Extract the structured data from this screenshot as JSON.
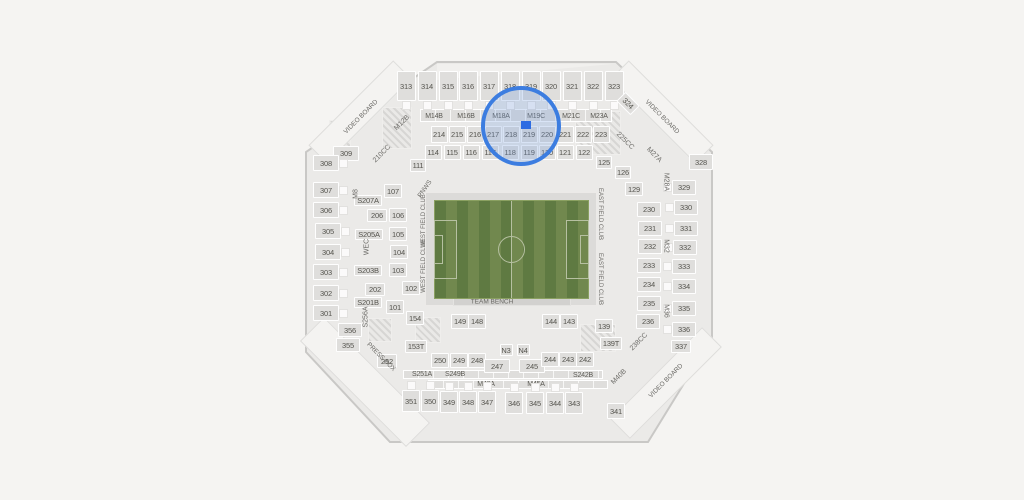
{
  "app": {
    "description": "Stadium seating map with zoom highlight on section 219"
  },
  "colors": {
    "background": "#f5f4f2",
    "bowl_fill": "#ebeae8",
    "bowl_stroke": "#c9c8c6",
    "section_fill": "#dfdedc",
    "section_border": "#ffffff",
    "label": "#55544e",
    "field_dark": "#5f7a42",
    "field_light": "#71884e",
    "field_lines": "#b6c0a1",
    "highlight_stroke": "#3c7de0",
    "highlight_fill": "rgba(120,158,223,0.28)",
    "marker_blue": "#2e6ce2"
  },
  "highlight": {
    "cx": 521,
    "cy": 126,
    "d": 80,
    "marker": {
      "x": 521,
      "y": 121,
      "w": 10,
      "h": 8
    }
  },
  "strips": [
    {
      "x": 516,
      "y": 115,
      "w": 192,
      "h": 13
    },
    {
      "x": 503,
      "y": 374,
      "w": 200,
      "h": 9
    },
    {
      "x": 518,
      "y": 384,
      "w": 180,
      "h": 9
    },
    {
      "x": 511,
      "y": 249,
      "w": 172,
      "h": 114,
      "c": "frame"
    },
    {
      "x": 512,
      "y": 301,
      "w": 118,
      "h": 9,
      "c": "bench"
    }
  ],
  "videoboards": [
    {
      "x": 360,
      "y": 112,
      "w": 120,
      "h": 26,
      "r": -45
    },
    {
      "x": 662,
      "y": 112,
      "w": 120,
      "h": 26,
      "r": 45
    },
    {
      "x": 666,
      "y": 383,
      "w": 130,
      "h": 28,
      "r": -45
    },
    {
      "x": 365,
      "y": 382,
      "w": 150,
      "h": 34,
      "r": 45
    }
  ],
  "hatches": [
    {
      "x": 397,
      "y": 128,
      "w": 30,
      "h": 42
    },
    {
      "x": 340,
      "y": 135,
      "w": 22,
      "h": 30
    },
    {
      "x": 598,
      "y": 133,
      "w": 46,
      "h": 44
    },
    {
      "x": 428,
      "y": 330,
      "w": 26,
      "h": 26
    },
    {
      "x": 598,
      "y": 338,
      "w": 36,
      "h": 28
    },
    {
      "x": 380,
      "y": 330,
      "w": 24,
      "h": 24
    }
  ],
  "sections": [
    {
      "t": "313",
      "x": 406,
      "y": 86,
      "w": 19,
      "h": 30,
      "c": "amb"
    },
    {
      "t": "314",
      "x": 427,
      "y": 86,
      "w": 19,
      "h": 30,
      "c": "amb"
    },
    {
      "t": "315",
      "x": 448,
      "y": 86,
      "w": 19,
      "h": 30,
      "c": "amb"
    },
    {
      "t": "316",
      "x": 468,
      "y": 86,
      "w": 19,
      "h": 30,
      "c": "amb"
    },
    {
      "t": "317",
      "x": 489,
      "y": 86,
      "w": 19,
      "h": 30,
      "c": "amb"
    },
    {
      "t": "318",
      "x": 510,
      "y": 86,
      "w": 19,
      "h": 30,
      "c": "amb"
    },
    {
      "t": "319",
      "x": 531,
      "y": 86,
      "w": 19,
      "h": 30,
      "c": "amb"
    },
    {
      "t": "320",
      "x": 551,
      "y": 86,
      "w": 19,
      "h": 30,
      "c": "amb"
    },
    {
      "t": "321",
      "x": 572,
      "y": 86,
      "w": 19,
      "h": 30,
      "c": "amb"
    },
    {
      "t": "322",
      "x": 593,
      "y": 86,
      "w": 19,
      "h": 30,
      "c": "amb"
    },
    {
      "t": "323",
      "x": 614,
      "y": 86,
      "w": 19,
      "h": 30,
      "c": "amb"
    },
    {
      "t": "324",
      "x": 628,
      "y": 103,
      "w": 20,
      "h": 13,
      "r": 45
    },
    {
      "t": "M14B",
      "x": 434,
      "y": 116,
      "w": 28,
      "h": 11,
      "c": "mbox"
    },
    {
      "t": "M16B",
      "x": 466,
      "y": 116,
      "w": 28,
      "h": 11,
      "c": "mbox"
    },
    {
      "t": "M18A",
      "x": 501,
      "y": 116,
      "w": 28,
      "h": 11,
      "c": "mbox"
    },
    {
      "t": "M19C",
      "x": 536,
      "y": 116,
      "w": 28,
      "h": 11,
      "c": "mbox"
    },
    {
      "t": "M21C",
      "x": 571,
      "y": 116,
      "w": 28,
      "h": 11,
      "c": "mbox"
    },
    {
      "t": "M23A",
      "x": 599,
      "y": 116,
      "w": 28,
      "h": 11,
      "c": "mbox"
    },
    {
      "t": "214",
      "x": 439,
      "y": 134,
      "w": 17,
      "h": 17
    },
    {
      "t": "215",
      "x": 457,
      "y": 134,
      "w": 17,
      "h": 17
    },
    {
      "t": "216",
      "x": 475,
      "y": 134,
      "w": 17,
      "h": 17
    },
    {
      "t": "217",
      "x": 493,
      "y": 134,
      "w": 17,
      "h": 17
    },
    {
      "t": "218",
      "x": 511,
      "y": 134,
      "w": 17,
      "h": 17
    },
    {
      "t": "219",
      "x": 529,
      "y": 134,
      "w": 17,
      "h": 17
    },
    {
      "t": "220",
      "x": 547,
      "y": 134,
      "w": 17,
      "h": 17
    },
    {
      "t": "221",
      "x": 565,
      "y": 134,
      "w": 17,
      "h": 17
    },
    {
      "t": "222",
      "x": 583,
      "y": 134,
      "w": 17,
      "h": 17
    },
    {
      "t": "223",
      "x": 601,
      "y": 134,
      "w": 17,
      "h": 17
    },
    {
      "t": "114",
      "x": 433,
      "y": 152,
      "w": 17,
      "h": 15
    },
    {
      "t": "115",
      "x": 452,
      "y": 152,
      "w": 17,
      "h": 15
    },
    {
      "t": "116",
      "x": 471,
      "y": 152,
      "w": 17,
      "h": 15
    },
    {
      "t": "117",
      "x": 490,
      "y": 152,
      "w": 17,
      "h": 15
    },
    {
      "t": "118",
      "x": 510,
      "y": 152,
      "w": 17,
      "h": 15
    },
    {
      "t": "119",
      "x": 529,
      "y": 152,
      "w": 17,
      "h": 15
    },
    {
      "t": "120",
      "x": 547,
      "y": 152,
      "w": 17,
      "h": 15
    },
    {
      "t": "121",
      "x": 565,
      "y": 152,
      "w": 17,
      "h": 15
    },
    {
      "t": "122",
      "x": 584,
      "y": 152,
      "w": 17,
      "h": 15
    },
    {
      "t": "111",
      "x": 418,
      "y": 165,
      "w": 16,
      "h": 13
    },
    {
      "t": "125",
      "x": 604,
      "y": 162,
      "w": 16,
      "h": 13
    },
    {
      "t": "126",
      "x": 623,
      "y": 172,
      "w": 16,
      "h": 13
    },
    {
      "t": "129",
      "x": 634,
      "y": 189,
      "w": 18,
      "h": 14
    },
    {
      "t": "309",
      "x": 346,
      "y": 153,
      "w": 26,
      "h": 15
    },
    {
      "t": "308",
      "x": 326,
      "y": 163,
      "w": 26,
      "h": 16,
      "c": "amr"
    },
    {
      "t": "307",
      "x": 326,
      "y": 190,
      "w": 26,
      "h": 16,
      "c": "amr"
    },
    {
      "t": "306",
      "x": 326,
      "y": 210,
      "w": 26,
      "h": 16,
      "c": "amr"
    },
    {
      "t": "305",
      "x": 328,
      "y": 231,
      "w": 26,
      "h": 16,
      "c": "amr"
    },
    {
      "t": "304",
      "x": 328,
      "y": 252,
      "w": 26,
      "h": 16,
      "c": "amr"
    },
    {
      "t": "303",
      "x": 326,
      "y": 272,
      "w": 26,
      "h": 16,
      "c": "amr"
    },
    {
      "t": "302",
      "x": 326,
      "y": 293,
      "w": 26,
      "h": 16,
      "c": "amr"
    },
    {
      "t": "301",
      "x": 326,
      "y": 313,
      "w": 26,
      "h": 16,
      "c": "amr"
    },
    {
      "t": "356",
      "x": 350,
      "y": 330,
      "w": 24,
      "h": 14
    },
    {
      "t": "355",
      "x": 348,
      "y": 345,
      "w": 24,
      "h": 14
    },
    {
      "t": "S207A",
      "x": 368,
      "y": 200,
      "w": 28,
      "h": 11
    },
    {
      "t": "206",
      "x": 377,
      "y": 215,
      "w": 20,
      "h": 13
    },
    {
      "t": "S205A",
      "x": 369,
      "y": 234,
      "w": 28,
      "h": 11
    },
    {
      "t": "S203B",
      "x": 368,
      "y": 270,
      "w": 28,
      "h": 11
    },
    {
      "t": "202",
      "x": 375,
      "y": 289,
      "w": 20,
      "h": 13
    },
    {
      "t": "S201B",
      "x": 368,
      "y": 302,
      "w": 28,
      "h": 11
    },
    {
      "t": "107",
      "x": 393,
      "y": 191,
      "w": 18,
      "h": 14
    },
    {
      "t": "106",
      "x": 398,
      "y": 215,
      "w": 18,
      "h": 14
    },
    {
      "t": "105",
      "x": 398,
      "y": 234,
      "w": 18,
      "h": 14
    },
    {
      "t": "104",
      "x": 399,
      "y": 252,
      "w": 18,
      "h": 14
    },
    {
      "t": "103",
      "x": 398,
      "y": 270,
      "w": 18,
      "h": 14
    },
    {
      "t": "102",
      "x": 411,
      "y": 288,
      "w": 18,
      "h": 14
    },
    {
      "t": "101",
      "x": 395,
      "y": 307,
      "w": 18,
      "h": 14
    },
    {
      "t": "154",
      "x": 415,
      "y": 318,
      "w": 18,
      "h": 14
    },
    {
      "t": "230",
      "x": 649,
      "y": 209,
      "w": 24,
      "h": 15
    },
    {
      "t": "231",
      "x": 650,
      "y": 228,
      "w": 24,
      "h": 15
    },
    {
      "t": "232",
      "x": 650,
      "y": 246,
      "w": 24,
      "h": 15
    },
    {
      "t": "233",
      "x": 649,
      "y": 265,
      "w": 24,
      "h": 15
    },
    {
      "t": "234",
      "x": 649,
      "y": 284,
      "w": 24,
      "h": 15
    },
    {
      "t": "235",
      "x": 649,
      "y": 303,
      "w": 24,
      "h": 15
    },
    {
      "t": "236",
      "x": 648,
      "y": 321,
      "w": 24,
      "h": 15
    },
    {
      "t": "328",
      "x": 701,
      "y": 162,
      "w": 24,
      "h": 16
    },
    {
      "t": "329",
      "x": 684,
      "y": 187,
      "w": 24,
      "h": 15,
      "c": "aml"
    },
    {
      "t": "330",
      "x": 686,
      "y": 207,
      "w": 24,
      "h": 15,
      "c": "aml"
    },
    {
      "t": "331",
      "x": 686,
      "y": 228,
      "w": 24,
      "h": 15,
      "c": "aml"
    },
    {
      "t": "332",
      "x": 685,
      "y": 247,
      "w": 24,
      "h": 15,
      "c": "aml"
    },
    {
      "t": "333",
      "x": 684,
      "y": 266,
      "w": 24,
      "h": 15,
      "c": "aml"
    },
    {
      "t": "334",
      "x": 684,
      "y": 286,
      "w": 24,
      "h": 15,
      "c": "aml"
    },
    {
      "t": "335",
      "x": 684,
      "y": 308,
      "w": 24,
      "h": 15,
      "c": "aml"
    },
    {
      "t": "336",
      "x": 684,
      "y": 329,
      "w": 24,
      "h": 15,
      "c": "aml"
    },
    {
      "t": "337",
      "x": 681,
      "y": 346,
      "w": 20,
      "h": 13
    },
    {
      "t": "149",
      "x": 460,
      "y": 321,
      "w": 18,
      "h": 15
    },
    {
      "t": "148",
      "x": 477,
      "y": 321,
      "w": 18,
      "h": 15
    },
    {
      "t": "144",
      "x": 551,
      "y": 321,
      "w": 18,
      "h": 15
    },
    {
      "t": "143",
      "x": 569,
      "y": 321,
      "w": 18,
      "h": 15
    },
    {
      "t": "139",
      "x": 604,
      "y": 326,
      "w": 18,
      "h": 14
    },
    {
      "t": "153T",
      "x": 416,
      "y": 346,
      "w": 22,
      "h": 13
    },
    {
      "t": "139T",
      "x": 611,
      "y": 343,
      "w": 22,
      "h": 13
    },
    {
      "t": "N3",
      "x": 506,
      "y": 350,
      "w": 13,
      "h": 12
    },
    {
      "t": "N4",
      "x": 523,
      "y": 350,
      "w": 13,
      "h": 12
    },
    {
      "t": "252",
      "x": 387,
      "y": 361,
      "w": 20,
      "h": 14
    },
    {
      "t": "250",
      "x": 440,
      "y": 360,
      "w": 18,
      "h": 15
    },
    {
      "t": "249",
      "x": 459,
      "y": 360,
      "w": 18,
      "h": 15
    },
    {
      "t": "248",
      "x": 477,
      "y": 360,
      "w": 18,
      "h": 15
    },
    {
      "t": "247",
      "x": 497,
      "y": 366,
      "w": 26,
      "h": 14
    },
    {
      "t": "245",
      "x": 532,
      "y": 366,
      "w": 26,
      "h": 14
    },
    {
      "t": "244",
      "x": 550,
      "y": 359,
      "w": 18,
      "h": 15
    },
    {
      "t": "243",
      "x": 568,
      "y": 359,
      "w": 18,
      "h": 15
    },
    {
      "t": "242",
      "x": 585,
      "y": 359,
      "w": 18,
      "h": 15
    },
    {
      "t": "S251A",
      "x": 422,
      "y": 374,
      "w": 30,
      "h": 9,
      "c": "mbox"
    },
    {
      "t": "S249B",
      "x": 455,
      "y": 374,
      "w": 30,
      "h": 9,
      "c": "mbox"
    },
    {
      "t": "S242B",
      "x": 583,
      "y": 375,
      "w": 30,
      "h": 9,
      "c": "mbox"
    },
    {
      "t": "M48A",
      "x": 486,
      "y": 384,
      "w": 28,
      "h": 9,
      "c": "mbox"
    },
    {
      "t": "M45A",
      "x": 536,
      "y": 384,
      "w": 28,
      "h": 9,
      "c": "mbox"
    },
    {
      "t": "351",
      "x": 411,
      "y": 401,
      "w": 18,
      "h": 22,
      "c": "amt"
    },
    {
      "t": "350",
      "x": 430,
      "y": 401,
      "w": 18,
      "h": 22,
      "c": "amt"
    },
    {
      "t": "349",
      "x": 449,
      "y": 402,
      "w": 18,
      "h": 22,
      "c": "amt"
    },
    {
      "t": "348",
      "x": 468,
      "y": 402,
      "w": 18,
      "h": 22,
      "c": "amt"
    },
    {
      "t": "347",
      "x": 487,
      "y": 402,
      "w": 18,
      "h": 22,
      "c": "amt"
    },
    {
      "t": "346",
      "x": 514,
      "y": 403,
      "w": 18,
      "h": 22,
      "c": "amt"
    },
    {
      "t": "345",
      "x": 535,
      "y": 403,
      "w": 18,
      "h": 22,
      "c": "amt"
    },
    {
      "t": "344",
      "x": 555,
      "y": 403,
      "w": 18,
      "h": 22,
      "c": "amt"
    },
    {
      "t": "343",
      "x": 574,
      "y": 403,
      "w": 18,
      "h": 22,
      "c": "amt"
    },
    {
      "t": "341",
      "x": 616,
      "y": 411,
      "w": 18,
      "h": 16
    }
  ],
  "labels": [
    {
      "t": "VIDEO BOARD",
      "x": 361,
      "y": 117,
      "r": -45,
      "s": 6.5
    },
    {
      "t": "M12B",
      "x": 402,
      "y": 123,
      "r": -45
    },
    {
      "t": "210CC",
      "x": 382,
      "y": 154,
      "r": -45
    },
    {
      "t": "PNWS",
      "x": 425,
      "y": 189,
      "r": -55,
      "s": 6.5
    },
    {
      "t": "VIDEO BOARD",
      "x": 662,
      "y": 117,
      "r": 45,
      "s": 6.5
    },
    {
      "t": "225CC",
      "x": 625,
      "y": 141,
      "r": 45
    },
    {
      "t": "M27A",
      "x": 654,
      "y": 155,
      "r": 45
    },
    {
      "t": "VIDEO BOARD",
      "x": 666,
      "y": 381,
      "r": -45,
      "s": 6.5
    },
    {
      "t": "M40B",
      "x": 619,
      "y": 377,
      "r": -45
    },
    {
      "t": "238CC",
      "x": 639,
      "y": 342,
      "r": -45
    },
    {
      "t": "PRESS BOX",
      "x": 381,
      "y": 357,
      "r": 45,
      "s": 6.5
    },
    {
      "t": "M8",
      "x": 356,
      "y": 194,
      "r": -90
    },
    {
      "t": "WEC",
      "x": 367,
      "y": 247,
      "r": -90
    },
    {
      "t": "S256A",
      "x": 366,
      "y": 317,
      "r": -90
    },
    {
      "t": "M28A",
      "x": 666,
      "y": 182,
      "r": 90
    },
    {
      "t": "M32",
      "x": 666,
      "y": 246,
      "r": 90
    },
    {
      "t": "M36",
      "x": 666,
      "y": 311,
      "r": 90
    },
    {
      "t": "WEST FIELD CLUB",
      "x": 424,
      "y": 221,
      "r": -90,
      "s": 6
    },
    {
      "t": "WEST FIELD CLUB",
      "x": 424,
      "y": 266,
      "r": -90,
      "s": 6
    },
    {
      "t": "EAST FIELD CLUB",
      "x": 600,
      "y": 214,
      "r": 90,
      "s": 6
    },
    {
      "t": "EAST FIELD CLUB",
      "x": 600,
      "y": 279,
      "r": 90,
      "s": 6
    },
    {
      "t": "TEAM BENCH",
      "x": 492,
      "y": 302,
      "r": 0,
      "s": 6.5
    }
  ]
}
